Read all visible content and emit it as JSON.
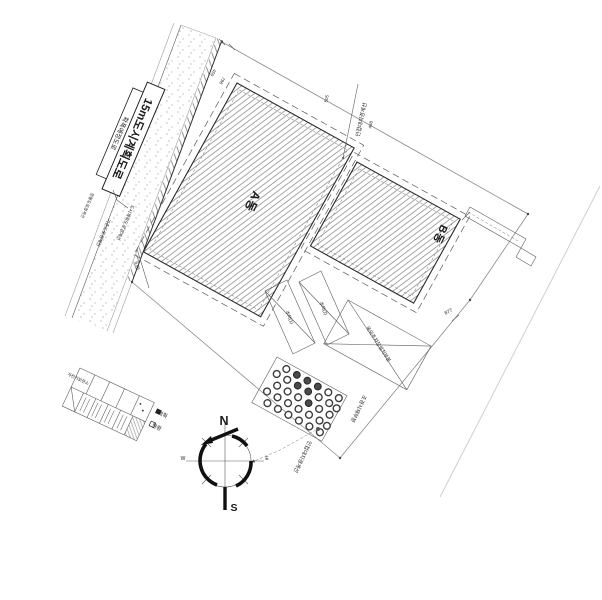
{
  "labels": {
    "road_main": "15m도시계획도로",
    "road_sub": "확폭예정도로",
    "building_a": "A동",
    "building_b": "B동",
    "ramp1": "주차(1)",
    "ramp2": "주차(2)",
    "parking_area": "옥외주차장설치부분",
    "landscape_area": "조경식재부분",
    "boundary_upper": "인접대지경계선",
    "boundary_lower": "인접대지경계선",
    "road_edge_left": "기존도로경계선",
    "road_edge_right": "도시계획도로경계선",
    "road_edge_outer": "현황도로경계선",
    "bike_storage": "자전거보관소"
  },
  "dimensions": {
    "d459": "459",
    "d798": "798",
    "d505": "505",
    "d488": "488",
    "d877": "877",
    "d605": "6.05"
  },
  "compass": {
    "north": "N",
    "south": "S",
    "west": "W",
    "east": "E"
  },
  "legend": {
    "item1": "계획",
    "item2": "현황"
  },
  "colors": {
    "ink": "#1c1c1c",
    "line": "#5c5c5c",
    "faint": "#c9c9c9",
    "paper": "#ffffff"
  }
}
